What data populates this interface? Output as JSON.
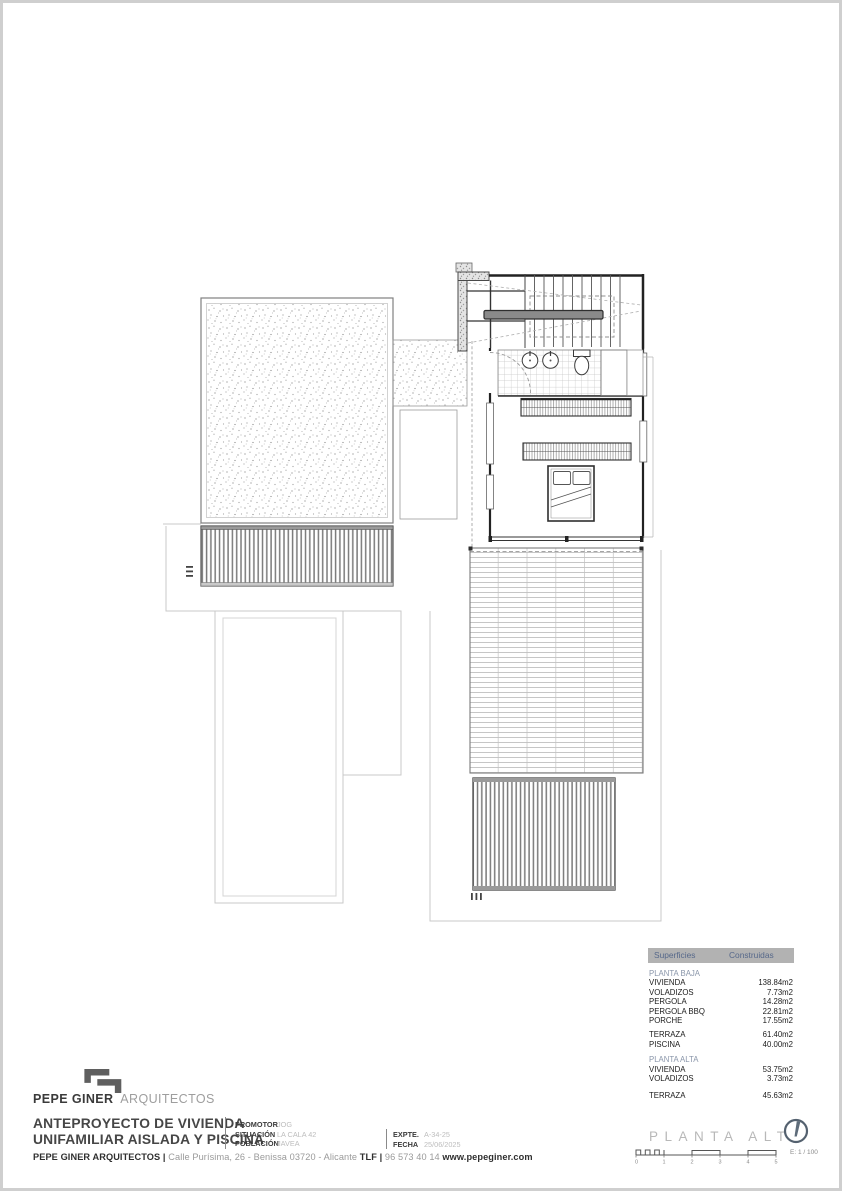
{
  "colors": {
    "accent_slate": "#56688a",
    "section_blue": "#8a96aa",
    "table_header_bg": "#b2b2b2",
    "ink_dark": "#2f2f2f",
    "value_light": "#bdbdbd",
    "plan_line": "#222222",
    "faint_underlay": "#c9c9c9"
  },
  "brand": {
    "name_strong": "PEPE GINER",
    "name_light": "ARQUITECTOS"
  },
  "title_block": {
    "project_line1": "ANTEPROYECTO DE VIVIENDA",
    "project_line2": "UNIFAMILIAR AISLADA Y PISCINA",
    "promotor_label": "PROMOTOR",
    "promotor_value": "JOG",
    "situacion_label": "SITUACIÓN",
    "situacion_value": "LA CALA 42",
    "poblacion_label": "POBLACIÓN",
    "poblacion_value": "JAVEA",
    "expte_label": "EXPTE.",
    "expte_value": "A-34-25",
    "fecha_label": "FECHA",
    "fecha_value": "25/06/2025"
  },
  "footer": {
    "segments": [
      "PEPE GINER ARQUITECTOS",
      " | ",
      "Calle Purísima, 26 - Benissa 03720 - Alicante ",
      "TLF",
      " | ",
      "96 573 40 14 ",
      "www.pepeginer.com"
    ]
  },
  "sheet_mark": {
    "drawing_title": "PLANTA ALTA",
    "scale_label": "E: 1 / 100",
    "scale_ticks": [
      "0",
      "1",
      "2",
      "3",
      "4",
      "5"
    ]
  },
  "areas_table": {
    "header_col1": "Superficies",
    "header_col2": "Construidas",
    "rows": [
      {
        "label": "PLANTA BAJA",
        "value": ""
      },
      {
        "label": "VIVIENDA",
        "value": "138.84m2"
      },
      {
        "label": "VOLADIZOS",
        "value": "7.73m2"
      },
      {
        "label": "PERGOLA",
        "value": "14.28m2"
      },
      {
        "label": "PERGOLA BBQ",
        "value": "22.81m2"
      },
      {
        "label": "PORCHE",
        "value": "17.55m2"
      },
      {
        "label": "TERRAZA",
        "value": "61.40m2"
      },
      {
        "label": "PISCINA",
        "value": "40.00m2"
      },
      {
        "label": "PLANTA ALTA",
        "value": ""
      },
      {
        "label": "VIVIENDA",
        "value": "53.75m2"
      },
      {
        "label": "VOLADIZOS",
        "value": "3.73m2"
      },
      {
        "label": "TERRAZA",
        "value": "45.63m2"
      }
    ]
  }
}
